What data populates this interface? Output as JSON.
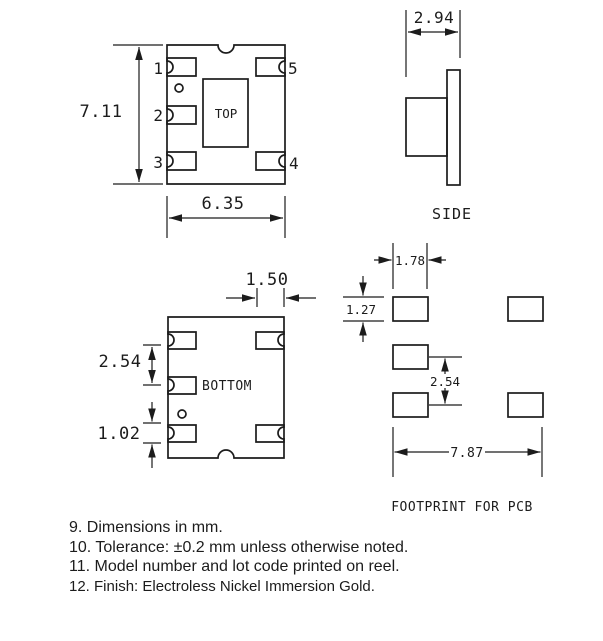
{
  "colors": {
    "ink": "#1c1c1c",
    "background": "#ffffff"
  },
  "views": {
    "top": {
      "label": "TOP",
      "pins": [
        "1",
        "2",
        "3",
        "4",
        "5"
      ],
      "dims": {
        "height": "7.11",
        "width": "6.35"
      }
    },
    "side": {
      "label": "SIDE",
      "dims": {
        "width": "2.94"
      }
    },
    "bottom": {
      "label": "BOTTOM",
      "dims": {
        "pad_width": "1.50",
        "pad_pitch": "2.54",
        "pad_height": "1.02"
      }
    },
    "footprint": {
      "label": "FOOTPRINT FOR PCB",
      "dims": {
        "pad_width": "1.78",
        "pad_height": "1.27",
        "pad_pitch": "2.54",
        "span": "7.87"
      }
    }
  },
  "notes": [
    "9. Dimensions in mm.",
    "10. Tolerance: ±0.2 mm unless otherwise noted.",
    "11. Model number and lot code printed on reel.",
    "12. Finish: Electroless Nickel Immersion Gold."
  ]
}
